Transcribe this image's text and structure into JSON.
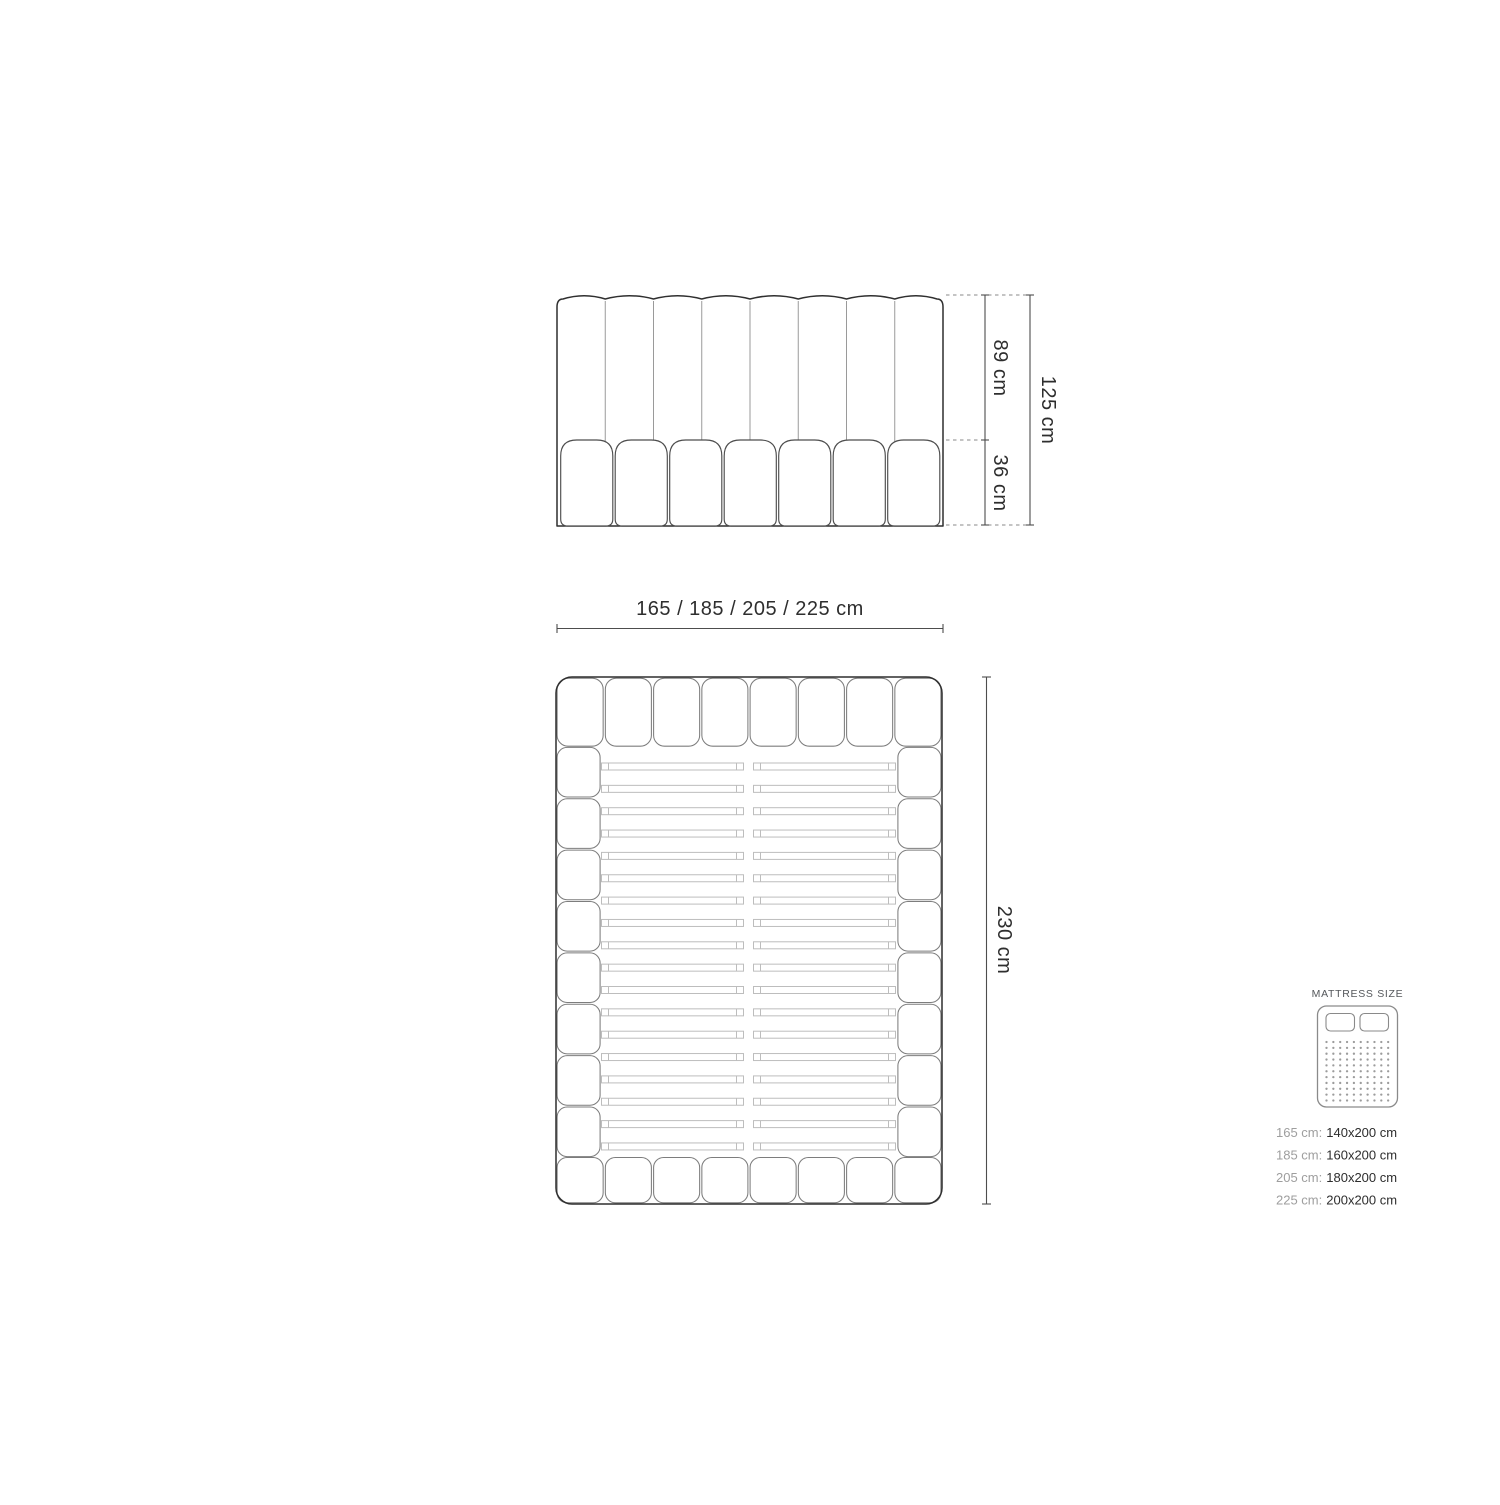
{
  "front_view": {
    "dim_upper": "89 cm",
    "dim_lower": "36 cm",
    "dim_total": "125 cm"
  },
  "top_view": {
    "dim_width": "165 / 185 / 205 / 225 cm",
    "dim_length": "230 cm"
  },
  "legend": {
    "title": "MATTRESS SIZE",
    "rows": [
      {
        "width": "165 cm:",
        "size": "140x200 cm"
      },
      {
        "width": "185 cm:",
        "size": "160x200 cm"
      },
      {
        "width": "205 cm:",
        "size": "180x200 cm"
      },
      {
        "width": "225 cm:",
        "size": "200x200 cm"
      }
    ]
  },
  "colors": {
    "outline": "#2f2f2f",
    "seam": "#9a9a9a",
    "pillow_seam": "#7d7d7d",
    "base_seam": "#4d4d4d",
    "slat": "#bdbdbd",
    "dimension_line": "#4d4d4d",
    "dashed_line": "#8a8a8a",
    "icon_stroke": "#8a8a8a",
    "dot": "#9c9c9c",
    "text": "#2d2d2d",
    "muted_text": "#9e9e9e"
  }
}
